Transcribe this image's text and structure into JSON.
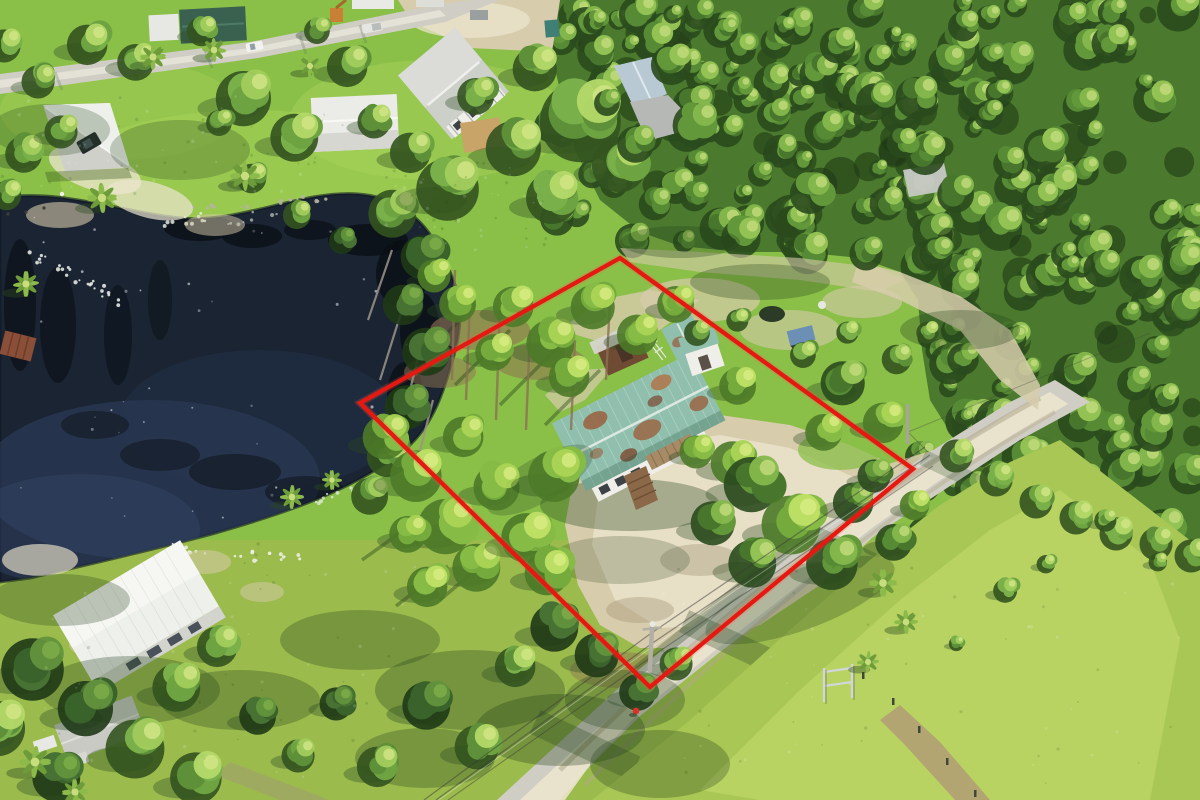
{
  "scene": {
    "kind": "aerial-drone-photograph",
    "subject": "wooded residential lot with red property-boundary overlay, pond, teal-roof house, dirt road",
    "width_px": 1200,
    "height_px": 800,
    "visible_text": "none"
  },
  "palette": {
    "lawn": "#8abf48",
    "lawnLight": "#a8d258",
    "lawnShadow": "#3f6a2a",
    "grassField": "#a9c754",
    "grassFieldLight": "#c0d96a",
    "grassBottom": "#9cbb4d",
    "forestBase": "#4b7a2e",
    "forestDark": "#27451b",
    "pondDeep": "#1a2433",
    "pondMid": "#273750",
    "pondLight": "#36486b",
    "reflection": "#0a0f15",
    "sand": "#d7ccab",
    "sandBright": "#ede6d0",
    "sandShadow": "#a3977a",
    "dirtBrown": "#8f7352",
    "roadGray": "#d0cec4",
    "roadLight": "#e9e6db",
    "roofWhite": "#eef0ec",
    "roofGray": "#cdcfc9",
    "roofTeal": "#90c0ad",
    "roofRust": "#9a5f3d",
    "roofGreenDark": "#3a614f",
    "roofBlueGray": "#b9c9d4",
    "wallWhite": "#efeee8",
    "woodBrown": "#7b5639",
    "deckBrown": "#8a6848",
    "boundaryRed": "#e41912",
    "wireDark": "#3a3a38",
    "tarpBlue": "#6b8fb5",
    "carDark": "#23282c",
    "gateSilver": "#d2d6d6",
    "trunkGray": "#9c9488",
    "trunkBrown": "#8a7054"
  },
  "boundary": {
    "name": "property-boundary",
    "shape": "quadrilateral",
    "color": "#e41912",
    "corners": [
      [
        620,
        258
      ],
      [
        913,
        469
      ],
      [
        650,
        687
      ],
      [
        360,
        403
      ]
    ]
  },
  "features": [
    {
      "name": "pond",
      "color": "#1a2433"
    },
    {
      "name": "main-house",
      "roof_color": "#90c0ad",
      "rust_color": "#9a5f3d"
    },
    {
      "name": "brown-shed"
    },
    {
      "name": "teal-shed"
    },
    {
      "name": "boat-dock"
    },
    {
      "name": "paved-street-top"
    },
    {
      "name": "dirt-road-bottom"
    },
    {
      "name": "sandy-driveway"
    },
    {
      "name": "grass-field-bottom-right"
    },
    {
      "name": "pine-forest"
    },
    {
      "name": "power-lines"
    },
    {
      "name": "utility-pole"
    },
    {
      "name": "metal-gate"
    },
    {
      "name": "person-marker",
      "color": "#d8352a",
      "x": 636,
      "y": 712
    },
    {
      "name": "neighbor-house-two-story"
    },
    {
      "name": "neighbor-carport-house"
    },
    {
      "name": "neighbor-white-building"
    },
    {
      "name": "neighbor-green-roof-trailer"
    },
    {
      "name": "neighbor-house-bottom-left"
    },
    {
      "name": "blue-tarp-debris"
    }
  ]
}
